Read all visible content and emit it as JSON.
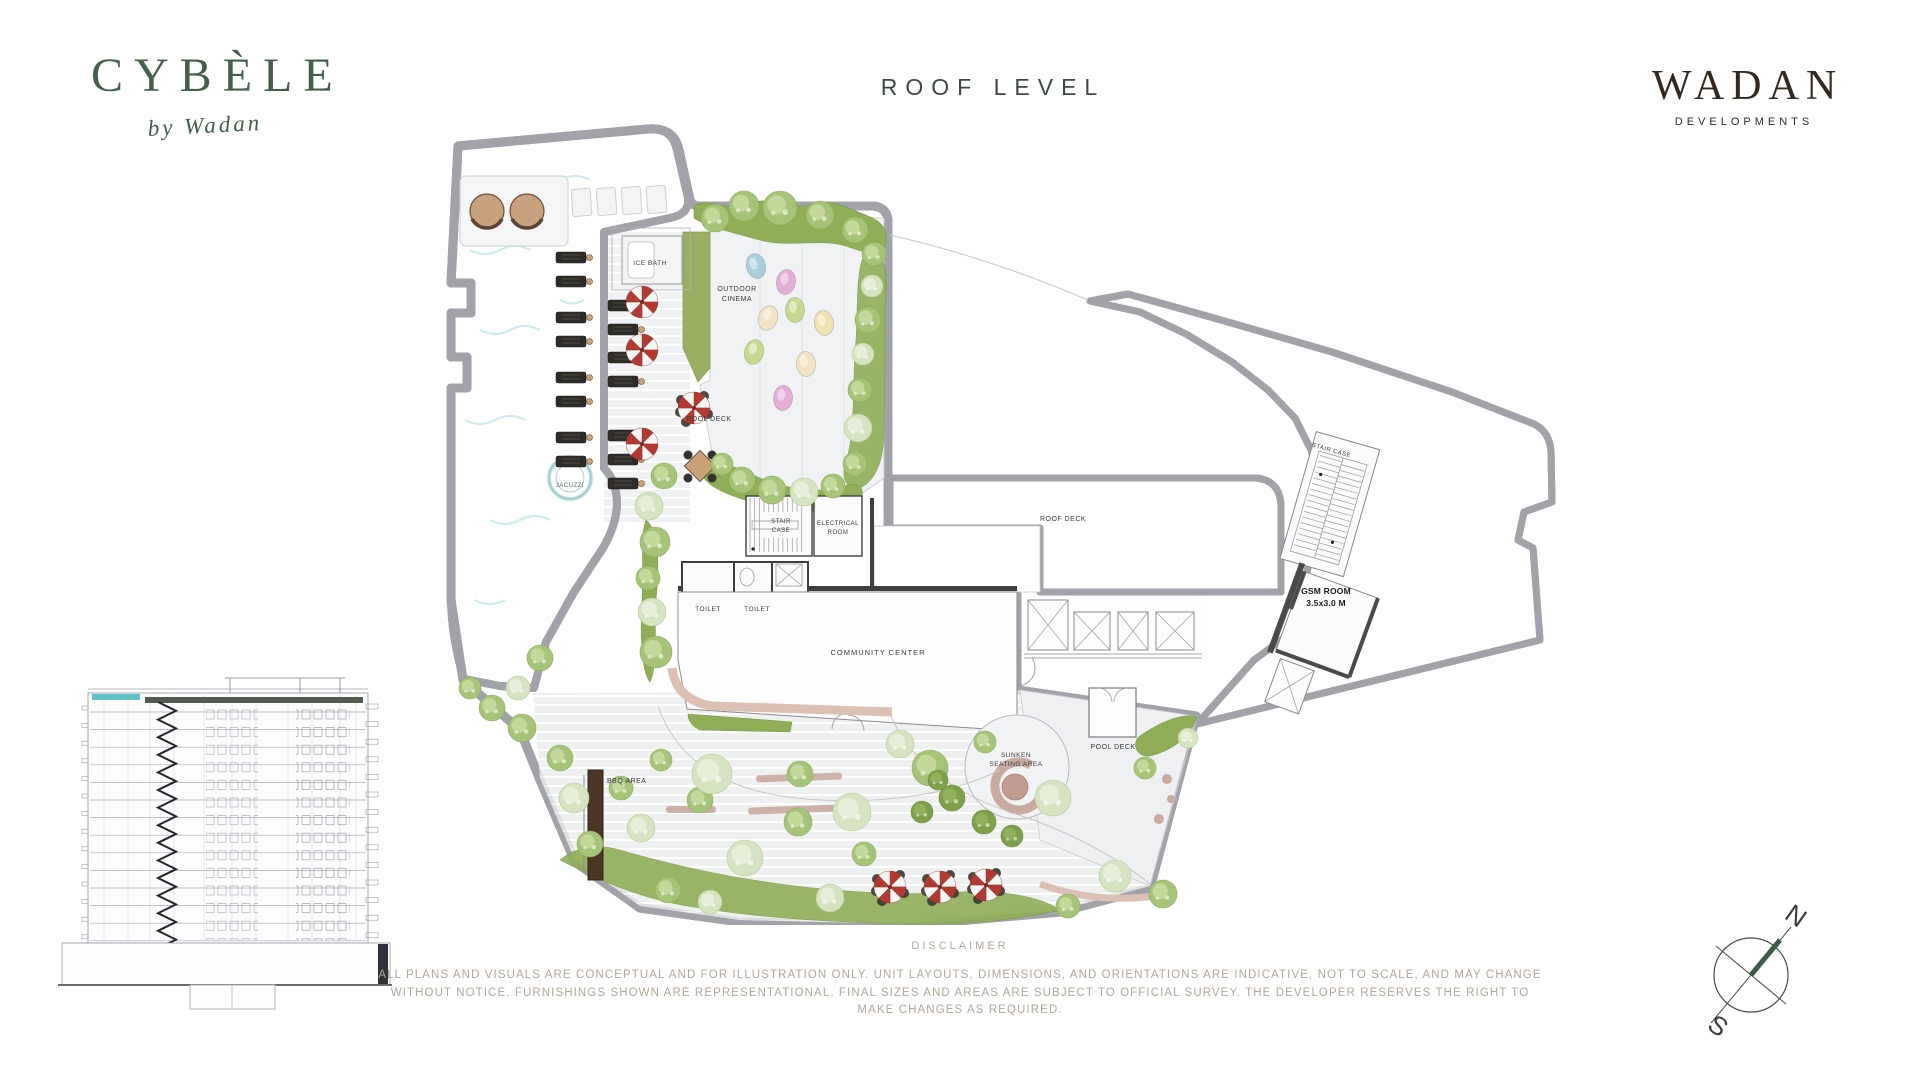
{
  "header": {
    "project": {
      "name": "CYBÈLE",
      "tagline": "by Wadan"
    },
    "page_title": "ROOF LEVEL",
    "developer": {
      "name": "WADAN",
      "subtitle": "DEVELOPMENTS"
    }
  },
  "plan": {
    "labels": {
      "ice_bath": "ICE BATH",
      "outdoor_cinema_line1": "OUTDOOR",
      "outdoor_cinema_line2": "CINEMA",
      "pool_deck_upper": "POOL DECK",
      "jacuzzi": "JACUZZI",
      "stair_case_line1": "STAIR",
      "stair_case_line2": "CASE",
      "electrical_line1": "ELECTRICAL",
      "electrical_line2": "ROOM",
      "toilet_left": "TOILET",
      "toilet_right": "TOILET",
      "community_center": "COMMUNITY CENTER",
      "roof_deck": "ROOF DECK",
      "stair_case_upper": "STAIR CASE",
      "gsm_line1": "GSM ROOM",
      "gsm_line2": "3.5x3.0 M",
      "sunken_line1": "SUNKEN",
      "sunken_line2": "SEATING AREA",
      "pool_deck_lower": "POOL DECK",
      "bbq_area": "BBQ AREA"
    }
  },
  "compass": {
    "north": "N",
    "south": "S"
  },
  "disclaimer": {
    "title": "DISCLAIMER",
    "body": "ALL PLANS AND VISUALS ARE CONCEPTUAL AND FOR ILLUSTRATION ONLY. UNIT LAYOUTS, DIMENSIONS, AND ORIENTATIONS ARE INDICATIVE, NOT TO SCALE, AND MAY CHANGE WITHOUT NOTICE. FURNISHINGS SHOWN ARE REPRESENTATIONAL. FINAL SIZES AND AREAS ARE SUBJECT TO OFFICIAL SURVEY. THE DEVELOPER RESERVES THE RIGHT TO MAKE CHANGES AS REQUIRED."
  },
  "colors": {
    "pool": "#5EC3C9",
    "brand_green": "#44604A",
    "brand_brown": "#33291F",
    "landscape_green": "#8FAE57",
    "umbrella_red": "#B23A30",
    "disclaimer_text": "#B3A799"
  }
}
